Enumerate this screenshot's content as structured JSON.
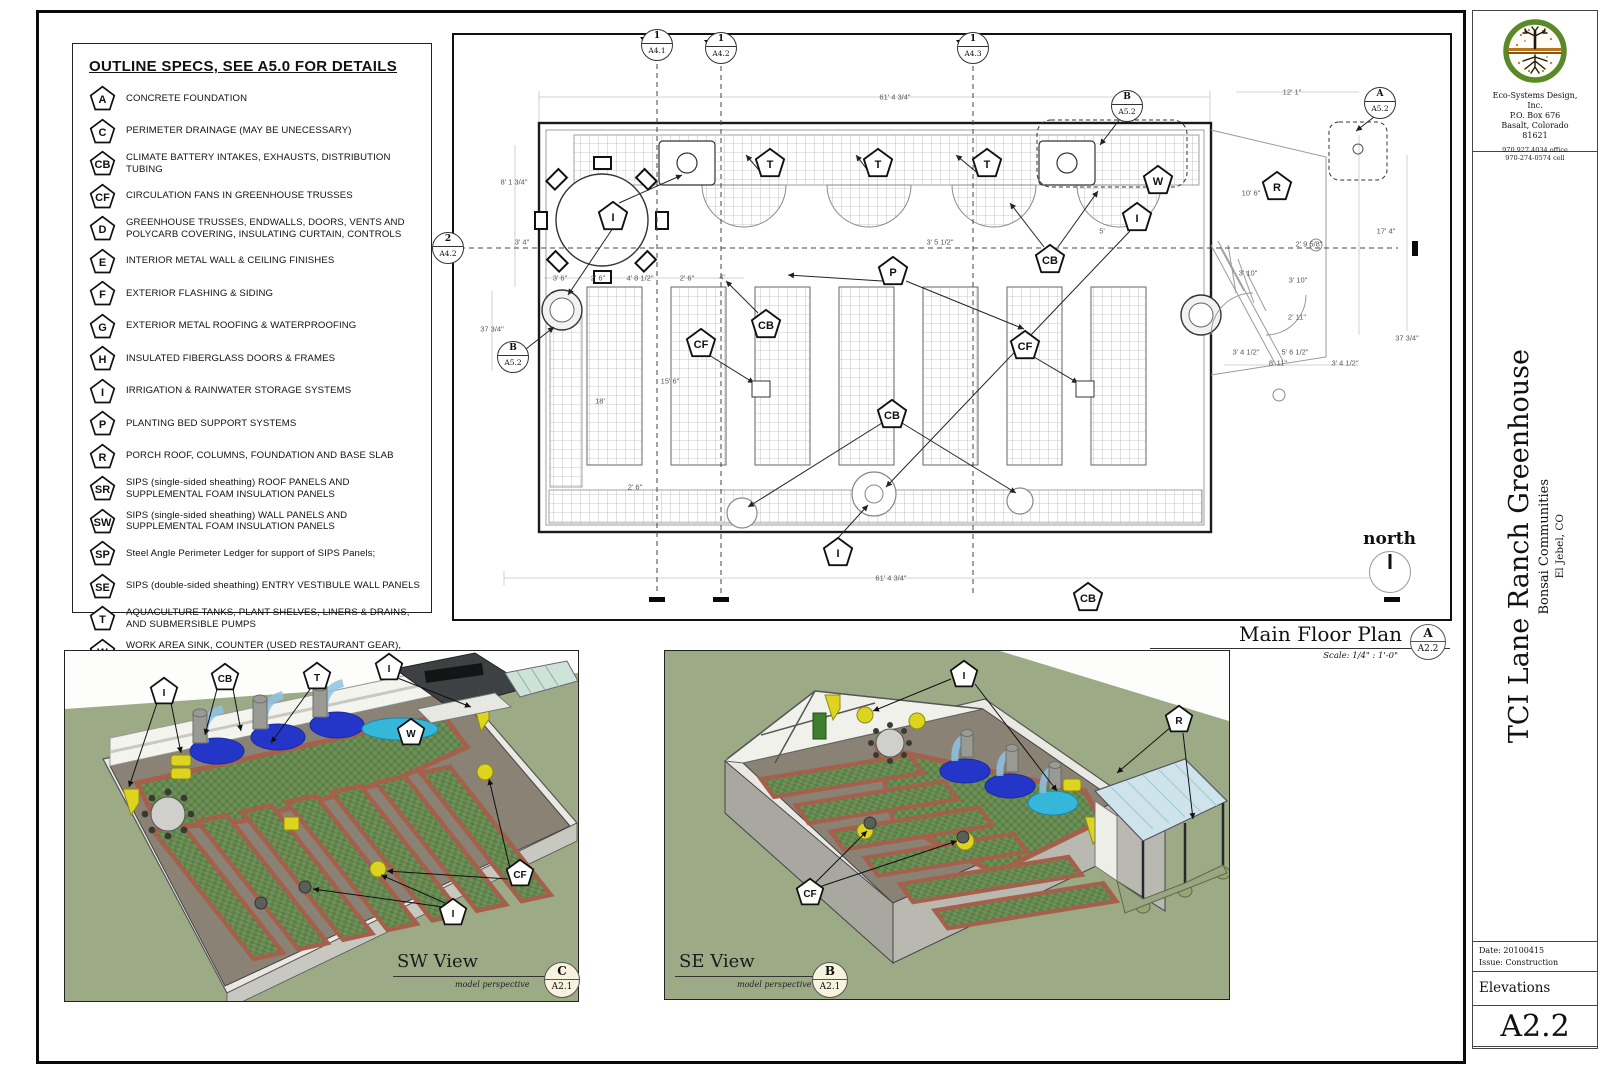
{
  "legend": {
    "title": "OUTLINE SPECS, SEE A5.0 FOR DETAILS",
    "items": [
      {
        "code": "A",
        "text": "CONCRETE FOUNDATION"
      },
      {
        "code": "C",
        "text": "PERIMETER DRAINAGE (MAY BE UNECESSARY)"
      },
      {
        "code": "CB",
        "text": "CLIMATE BATTERY INTAKES, EXHAUSTS, DISTRIBUTION TUBING"
      },
      {
        "code": "CF",
        "text": "CIRCULATION FANS IN GREENHOUSE TRUSSES"
      },
      {
        "code": "D",
        "text": "GREENHOUSE TRUSSES, ENDWALLS, DOORS, VENTS AND POLYCARB COVERING, INSULATING CURTAIN, CONTROLS"
      },
      {
        "code": "E",
        "text": "INTERIOR METAL WALL & CEILING FINISHES"
      },
      {
        "code": "F",
        "text": "EXTERIOR FLASHING & SIDING"
      },
      {
        "code": "G",
        "text": "EXTERIOR METAL ROOFING & WATERPROOFING"
      },
      {
        "code": "H",
        "text": "INSULATED FIBERGLASS DOORS & FRAMES"
      },
      {
        "code": "I",
        "text": "IRRIGATION & RAINWATER STORAGE SYSTEMS"
      },
      {
        "code": "P",
        "text": "PLANTING BED SUPPORT SYSTEMS"
      },
      {
        "code": "R",
        "text": "PORCH ROOF, COLUMNS, FOUNDATION AND BASE SLAB"
      },
      {
        "code": "SR",
        "text": "SIPS (single-sided sheathing) ROOF PANELS AND SUPPLEMENTAL FOAM INSULATION PANELS"
      },
      {
        "code": "SW",
        "text": "SIPS (single-sided sheathing) WALL PANELS AND SUPPLEMENTAL FOAM INSULATION PANELS"
      },
      {
        "code": "SP",
        "text": "Steel Angle Perimeter Ledger for support of SIPS Panels;"
      },
      {
        "code": "SE",
        "text": "SIPS (double-sided sheathing) ENTRY VESTIBULE WALL PANELS"
      },
      {
        "code": "T",
        "text": "AQUACULTURE TANKS,  PLANT SHELVES, LINERS & DRAINS, AND SUBMERSIBLE PUMPS"
      },
      {
        "code": "W",
        "text": "WORK AREA SINK, COUNTER (USED RESTAURANT GEAR), WALL RACKS AND WIRE BASKET SHELVES (see A5.2)"
      }
    ]
  },
  "plan": {
    "title": "Main Floor Plan",
    "scale": "Scale:  1/4\" : 1'-0\"",
    "callout": {
      "letter": "A",
      "sheet": "A2.2"
    },
    "north_label": "north",
    "section_markers": [
      {
        "num": "1",
        "sheet": "A4.1",
        "x": 203,
        "y": 10
      },
      {
        "num": "1",
        "sheet": "A4.2",
        "x": 267,
        "y": 13
      },
      {
        "num": "1",
        "sheet": "A4.3",
        "x": 519,
        "y": 13
      },
      {
        "num": "2",
        "sheet": "A4.2",
        "x": -6,
        "y": 213
      },
      {
        "num": "B",
        "sheet": "A5.2",
        "x": 673,
        "y": 71
      },
      {
        "num": "A",
        "sheet": "A5.2",
        "x": 926,
        "y": 68
      },
      {
        "num": "B",
        "sheet": "A5.2",
        "x": 59,
        "y": 322
      }
    ],
    "markers": [
      {
        "label": "I",
        "x": 159,
        "y": 181
      },
      {
        "label": "T",
        "x": 316,
        "y": 128
      },
      {
        "label": "T",
        "x": 424,
        "y": 128
      },
      {
        "label": "T",
        "x": 533,
        "y": 128
      },
      {
        "label": "W",
        "x": 704,
        "y": 145
      },
      {
        "label": "R",
        "x": 823,
        "y": 151
      },
      {
        "label": "I",
        "x": 683,
        "y": 182
      },
      {
        "label": "CB",
        "x": 596,
        "y": 224
      },
      {
        "label": "P",
        "x": 439,
        "y": 236
      },
      {
        "label": "CB",
        "x": 312,
        "y": 289
      },
      {
        "label": "CF",
        "x": 247,
        "y": 308
      },
      {
        "label": "CF",
        "x": 571,
        "y": 310
      },
      {
        "label": "CB",
        "x": 438,
        "y": 379
      },
      {
        "label": "I",
        "x": 384,
        "y": 517
      },
      {
        "label": "CB",
        "x": 634,
        "y": 562
      }
    ],
    "dims": [
      {
        "t": "61' 4 3/4\"",
        "x": 441,
        "y": 62
      },
      {
        "t": "12' 1\"",
        "x": 838,
        "y": 57
      },
      {
        "t": "8' 1 3/4\"",
        "x": 60,
        "y": 147
      },
      {
        "t": "3' 4\"",
        "x": 68,
        "y": 207
      },
      {
        "t": "37 3/4\"",
        "x": 38,
        "y": 294
      },
      {
        "t": "3' 6\"",
        "x": 106,
        "y": 243
      },
      {
        "t": "2' 6\"",
        "x": 144,
        "y": 243
      },
      {
        "t": "4' 8 1/2\"",
        "x": 186,
        "y": 243
      },
      {
        "t": "2' 6\"",
        "x": 233,
        "y": 243
      },
      {
        "t": "4'",
        "x": 268,
        "y": 242
      },
      {
        "t": "3' 5 1/2\"",
        "x": 486,
        "y": 207
      },
      {
        "t": "5'",
        "x": 648,
        "y": 196
      },
      {
        "t": "15' 6\"",
        "x": 216,
        "y": 346
      },
      {
        "t": "18'",
        "x": 146,
        "y": 366
      },
      {
        "t": "2' 6\"",
        "x": 181,
        "y": 452
      },
      {
        "t": "10' 6\"",
        "x": 797,
        "y": 158
      },
      {
        "t": "17' 4\"",
        "x": 932,
        "y": 196
      },
      {
        "t": "2' 9 5/8\"",
        "x": 855,
        "y": 209
      },
      {
        "t": "3' 10\"",
        "x": 794,
        "y": 238
      },
      {
        "t": "3' 10\"",
        "x": 844,
        "y": 245
      },
      {
        "t": "2' 11\"",
        "x": 843,
        "y": 282
      },
      {
        "t": "3' 4 1/2\"",
        "x": 792,
        "y": 317
      },
      {
        "t": "5' 6 1/2\"",
        "x": 841,
        "y": 317
      },
      {
        "t": "8' 11\"",
        "x": 824,
        "y": 328
      },
      {
        "t": "3' 4 1/2\"",
        "x": 891,
        "y": 328
      },
      {
        "t": "37 3/4\"",
        "x": 953,
        "y": 303
      },
      {
        "t": "61' 4 3/4\"",
        "x": 437,
        "y": 543
      }
    ]
  },
  "views": {
    "sw": {
      "name": "SW View",
      "sub": "model perspective",
      "callout": {
        "letter": "C",
        "sheet": "A2.1"
      },
      "markers": [
        {
          "label": "I",
          "x": 99,
          "y": 40
        },
        {
          "label": "CB",
          "x": 160,
          "y": 26
        },
        {
          "label": "T",
          "x": 252,
          "y": 25
        },
        {
          "label": "I",
          "x": 324,
          "y": 16
        },
        {
          "label": "W",
          "x": 346,
          "y": 81
        },
        {
          "label": "CF",
          "x": 455,
          "y": 222
        },
        {
          "label": "I",
          "x": 388,
          "y": 261
        }
      ]
    },
    "se": {
      "name": "SE View",
      "sub": "model perspective",
      "callout": {
        "letter": "B",
        "sheet": "A2.1"
      },
      "markers": [
        {
          "label": "I",
          "x": 299,
          "y": 23
        },
        {
          "label": "R",
          "x": 514,
          "y": 68
        },
        {
          "label": "CF",
          "x": 145,
          "y": 241
        }
      ]
    }
  },
  "title_block": {
    "company_line1": "Eco-Systems Design,",
    "company_line2": "Inc.",
    "company_line3": "P.O. Box 676",
    "company_line4": "Basalt, Colorado",
    "company_line5": "81621",
    "phone1": "970.927.4034 office",
    "phone2": "970-274-0574 cell",
    "project_title": "TCI Lane Ranch Greenhouse",
    "project_client": "Bonsai Communities",
    "project_location": "El Jebel, CO",
    "date": "Date: 20100415",
    "issue": "Issue: Construction",
    "sheet_name": "Elevations",
    "sheet_number": "A2.2"
  }
}
